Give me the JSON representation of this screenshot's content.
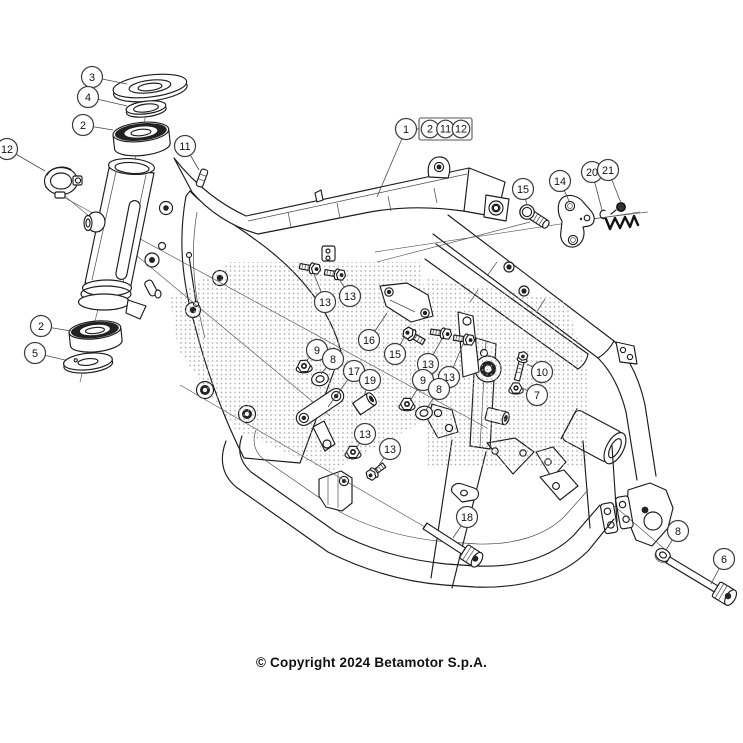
{
  "page": {
    "background": "#ffffff"
  },
  "diagram": {
    "type": "exploded-parts-diagram",
    "subject": "motorcycle frame assembly",
    "colors": {
      "line": "#1c1c1c",
      "leader": "#4a4a4a",
      "balloon_stroke": "#3b3b3b",
      "balloon_fill": "#ffffff",
      "text": "#111111",
      "halftone_dot": "#9c9c9c"
    },
    "callouts": [
      {
        "label": "3",
        "x": 92,
        "y": 77,
        "tx": 127,
        "ty": 84
      },
      {
        "label": "4",
        "x": 88,
        "y": 97,
        "tx": 127,
        "ty": 106
      },
      {
        "label": "2",
        "x": 83,
        "y": 125,
        "tx": 113,
        "ty": 130
      },
      {
        "label": "12",
        "x": 7,
        "y": 149,
        "tx": 45,
        "ty": 171
      },
      {
        "label": "11",
        "x": 185,
        "y": 146,
        "tx": 199,
        "ty": 170
      },
      {
        "label": "1",
        "x": 406,
        "y": 129,
        "tx": 377,
        "ty": 197
      },
      {
        "label": "15",
        "x": 523,
        "y": 189,
        "tx": 527,
        "ty": 205
      },
      {
        "label": "14",
        "x": 560,
        "y": 181,
        "tx": 569,
        "ty": 201
      },
      {
        "label": "20",
        "x": 592,
        "y": 172,
        "tx": 602,
        "ty": 210
      },
      {
        "label": "21",
        "x": 608,
        "y": 170,
        "tx": 621,
        "ty": 203
      },
      {
        "label": "2",
        "x": 41,
        "y": 326,
        "tx": 71,
        "ty": 331
      },
      {
        "label": "5",
        "x": 35,
        "y": 353,
        "tx": 65,
        "ty": 360
      },
      {
        "label": "13",
        "x": 325,
        "y": 302,
        "tx": 314,
        "ty": 274
      },
      {
        "label": "13",
        "x": 350,
        "y": 296,
        "tx": 339,
        "ty": 279
      },
      {
        "label": "9",
        "x": 317,
        "y": 350,
        "tx": 306,
        "ty": 361
      },
      {
        "label": "8",
        "x": 333,
        "y": 359,
        "tx": 321,
        "ty": 374
      },
      {
        "label": "16",
        "x": 369,
        "y": 340,
        "tx": 387,
        "ty": 313
      },
      {
        "label": "15",
        "x": 395,
        "y": 354,
        "tx": 405,
        "ty": 336
      },
      {
        "label": "13",
        "x": 428,
        "y": 364,
        "tx": 443,
        "ty": 337
      },
      {
        "label": "13",
        "x": 449,
        "y": 377,
        "tx": 464,
        "ty": 342
      },
      {
        "label": "17",
        "x": 354,
        "y": 371,
        "tx": 328,
        "ty": 407
      },
      {
        "label": "19",
        "x": 370,
        "y": 380,
        "tx": 364,
        "ty": 396
      },
      {
        "label": "9",
        "x": 423,
        "y": 380,
        "tx": 410,
        "ty": 401
      },
      {
        "label": "8",
        "x": 439,
        "y": 389,
        "tx": 426,
        "ty": 410
      },
      {
        "label": "10",
        "x": 542,
        "y": 372,
        "tx": 527,
        "ty": 364
      },
      {
        "label": "7",
        "x": 537,
        "y": 395,
        "tx": 522,
        "ty": 388
      },
      {
        "label": "13",
        "x": 365,
        "y": 434,
        "tx": 356,
        "ty": 449
      },
      {
        "label": "13",
        "x": 390,
        "y": 449,
        "tx": 375,
        "ty": 471
      },
      {
        "label": "18",
        "x": 467,
        "y": 517,
        "tx": 453,
        "ty": 538
      },
      {
        "label": "8",
        "x": 678,
        "y": 531,
        "tx": 666,
        "ty": 550
      },
      {
        "label": "6",
        "x": 724,
        "y": 559,
        "tx": 711,
        "ty": 584
      }
    ],
    "callout_group_box": {
      "x": 419,
      "y": 118,
      "width": 53,
      "height": 22,
      "labels": [
        "2",
        "11",
        "12"
      ],
      "connects_to_label": "1"
    }
  },
  "footer": {
    "copyright": "© Copyright 2024 Betamotor S.p.A."
  }
}
